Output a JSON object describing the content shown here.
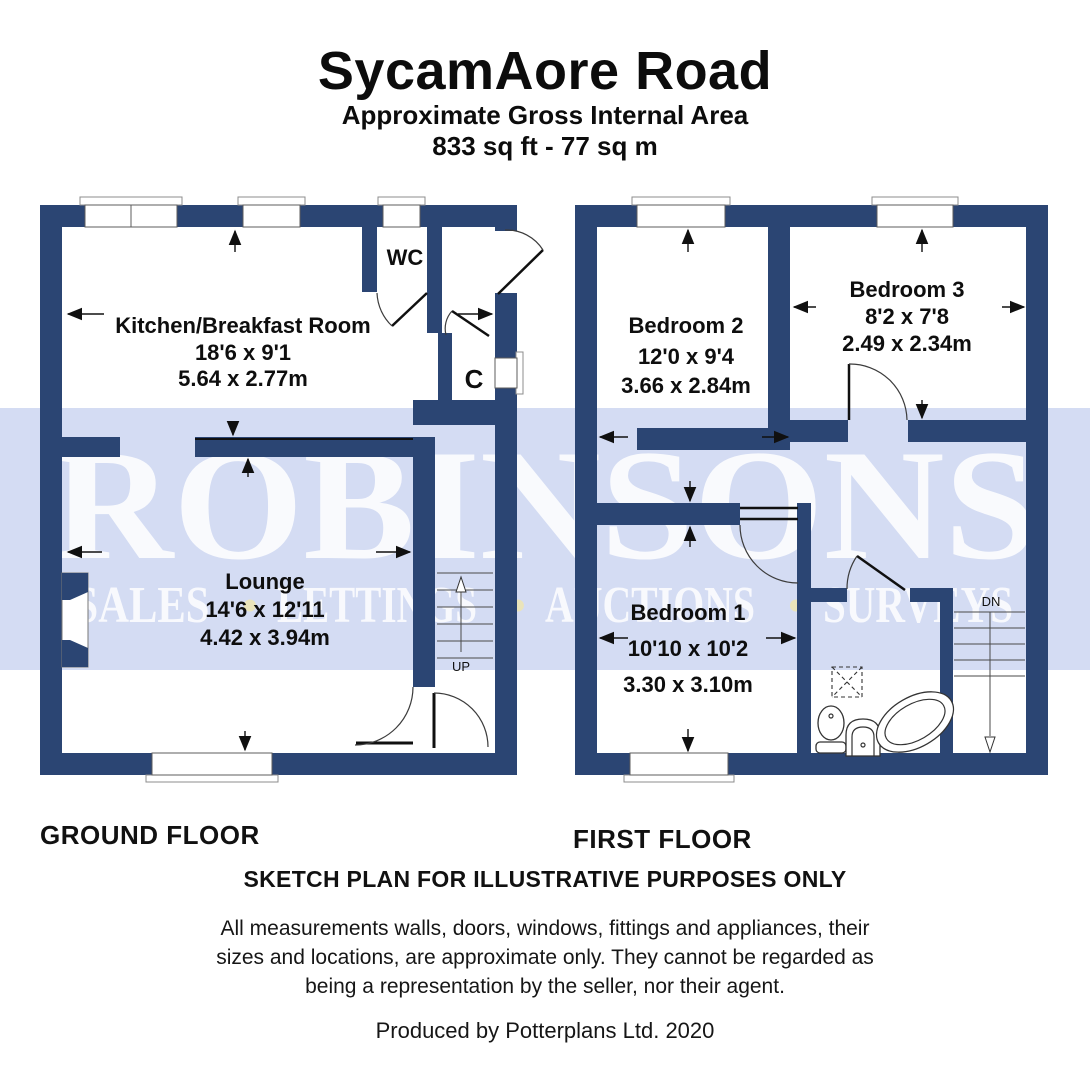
{
  "header": {
    "title": "SycamAore Road",
    "subtitle": "Approximate Gross Internal Area",
    "area": "833 sq ft - 77 sq m"
  },
  "watermark": {
    "name": "ROBINSONS",
    "separator": "•",
    "tagline_parts": [
      "SALES",
      "LETTINGS",
      "AUCTIONS",
      "SURVEYS"
    ],
    "band_color": "#d4dcf3",
    "text_color": "#ffffff"
  },
  "colors": {
    "wall": "#2b4573",
    "background": "#ffffff"
  },
  "ground_floor": {
    "label": "GROUND FLOOR",
    "stairs_label": "UP",
    "rooms": {
      "kitchen": {
        "name": "Kitchen/Breakfast Room",
        "dims_imperial": "18'6 x 9'1",
        "dims_metric": "5.64 x 2.77m"
      },
      "lounge": {
        "name": "Lounge",
        "dims_imperial": "14'6 x 12'11",
        "dims_metric": "4.42 x 3.94m"
      },
      "wc": {
        "name": "WC"
      },
      "cupboard": {
        "name": "C"
      }
    }
  },
  "first_floor": {
    "label": "FIRST FLOOR",
    "stairs_label": "DN",
    "rooms": {
      "bedroom1": {
        "name": "Bedroom 1",
        "dims_imperial": "10'10 x 10'2",
        "dims_metric": "3.30 x 3.10m"
      },
      "bedroom2": {
        "name": "Bedroom 2",
        "dims_imperial": "12'0 x 9'4",
        "dims_metric": "3.66 x 2.84m"
      },
      "bedroom3": {
        "name": "Bedroom 3",
        "dims_imperial": "8'2 x 7'8",
        "dims_metric": "2.49 x 2.34m"
      }
    }
  },
  "footer": {
    "sketch_note": "SKETCH PLAN FOR ILLUSTRATIVE PURPOSES ONLY",
    "disclaimer_line1": "All measurements walls, doors, windows, fittings and appliances, their",
    "disclaimer_line2": "sizes and locations, are approximate only. They cannot be regarded as",
    "disclaimer_line3": "being a representation by the seller, nor their agent.",
    "credit": "Produced by Potterplans Ltd. 2020"
  }
}
